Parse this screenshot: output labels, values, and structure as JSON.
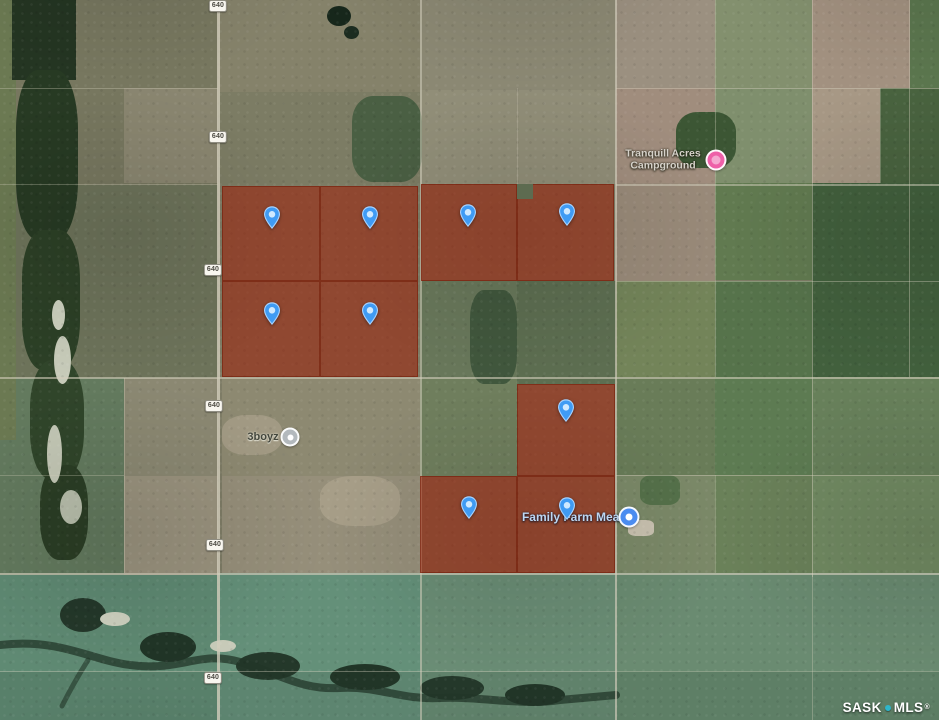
{
  "map": {
    "attribution": {
      "left": "SASK",
      "right": "MLS",
      "registered": "®",
      "dot_color": "#2eb6ca",
      "text_color": "#ffffff"
    },
    "highway_shield": {
      "label": "640",
      "positions": [
        {
          "x": 218,
          "y": 6
        },
        {
          "x": 218,
          "y": 137
        },
        {
          "x": 213,
          "y": 270
        },
        {
          "x": 214,
          "y": 406
        },
        {
          "x": 215,
          "y": 545
        },
        {
          "x": 213,
          "y": 678
        }
      ]
    },
    "poi_labels": [
      {
        "id": "tranquill-acres-campground",
        "lines": [
          "Tranquill Acres",
          "Campground"
        ],
        "style": "campground",
        "tx": 663,
        "ty": 160,
        "icon": {
          "name": "campground-poi-icon",
          "x": 716,
          "y": 160,
          "size": 17,
          "bg": "#ee60a8",
          "inner": "#f4a8d0",
          "inner_size": 9
        }
      },
      {
        "id": "threeboyz",
        "lines": [
          "3boyz"
        ],
        "style": "plain-dark",
        "tx": 263,
        "ty": 437,
        "icon": {
          "name": "generic-poi-icon",
          "x": 290,
          "y": 437,
          "size": 15,
          "bg": "#b3b9bd",
          "inner": "#ffffff",
          "inner_size": 6
        }
      },
      {
        "id": "family-farm-meats",
        "lines": [
          "Family Farm Meats"
        ],
        "style": "store",
        "tx": 576,
        "ty": 517,
        "icon": {
          "name": "store-poi-icon",
          "x": 629,
          "y": 517,
          "size": 17,
          "bg": "#4b8cf0",
          "inner": "#ffffff",
          "inner_size": 7
        }
      }
    ],
    "listing_pins": {
      "color_body": "#3f9bf4",
      "color_stroke": "#a6d2ff",
      "color_dot": "#cfe9ff",
      "points": [
        {
          "x": 272,
          "y": 234
        },
        {
          "x": 370,
          "y": 234
        },
        {
          "x": 468,
          "y": 232
        },
        {
          "x": 567,
          "y": 231
        },
        {
          "x": 272,
          "y": 330
        },
        {
          "x": 370,
          "y": 330
        },
        {
          "x": 566,
          "y": 427
        },
        {
          "x": 469,
          "y": 524
        },
        {
          "x": 567,
          "y": 525
        }
      ]
    },
    "parcel_overlays": {
      "fill": "rgba(158,30,5,0.55)",
      "border": "rgba(110,22,2,0.5)",
      "rects": [
        {
          "x": 222,
          "y": 186,
          "w": 98,
          "h": 95
        },
        {
          "x": 320,
          "y": 186,
          "w": 98,
          "h": 95
        },
        {
          "x": 222,
          "y": 281,
          "w": 98,
          "h": 96
        },
        {
          "x": 320,
          "y": 281,
          "w": 98,
          "h": 96
        },
        {
          "x": 421,
          "y": 184,
          "w": 96,
          "h": 97
        },
        {
          "x": 517,
          "y": 184,
          "w": 97,
          "h": 97
        },
        {
          "x": 517,
          "y": 384,
          "w": 98,
          "h": 92
        },
        {
          "x": 420,
          "y": 476,
          "w": 97,
          "h": 97
        },
        {
          "x": 517,
          "y": 476,
          "w": 98,
          "h": 97
        }
      ],
      "holes": [
        {
          "x": 517,
          "y": 184,
          "w": 16,
          "h": 15,
          "c": "#5d6b50"
        }
      ]
    },
    "roads": {
      "color": "#d2cdbb",
      "vertical": [
        {
          "x": 217,
          "y1": 0,
          "y2": 720,
          "w": 2.5,
          "o": 0.8
        },
        {
          "x": 420,
          "y1": 0,
          "y2": 720,
          "w": 1.5,
          "o": 0.55
        },
        {
          "x": 615,
          "y1": 0,
          "y2": 720,
          "w": 2,
          "o": 0.65
        },
        {
          "x": 812,
          "y1": 0,
          "y2": 577,
          "w": 1.2,
          "o": 0.45
        },
        {
          "x": 812,
          "y1": 573,
          "y2": 720,
          "w": 1.2,
          "o": 0.35
        },
        {
          "x": 909,
          "y1": 0,
          "y2": 377,
          "w": 1.2,
          "o": 0.4
        },
        {
          "x": 715,
          "y1": 0,
          "y2": 377,
          "w": 1,
          "o": 0.35
        },
        {
          "x": 715,
          "y1": 475,
          "y2": 573,
          "w": 1,
          "o": 0.3
        },
        {
          "x": 124,
          "y1": 378,
          "y2": 573,
          "w": 1,
          "o": 0.35
        },
        {
          "x": 880,
          "y1": 88,
          "y2": 183,
          "w": 1,
          "o": 0.3
        },
        {
          "x": 517,
          "y1": 88,
          "y2": 184,
          "w": 1,
          "o": 0.25
        }
      ],
      "horizontal": [
        {
          "y": 88,
          "x1": 0,
          "x2": 218,
          "h": 1,
          "o": 0.35
        },
        {
          "y": 88,
          "x1": 616,
          "x2": 939,
          "h": 1.2,
          "o": 0.45
        },
        {
          "y": 184,
          "x1": 616,
          "x2": 939,
          "h": 1.5,
          "o": 0.5
        },
        {
          "y": 184,
          "x1": 0,
          "x2": 218,
          "h": 1,
          "o": 0.3
        },
        {
          "y": 281,
          "x1": 616,
          "x2": 939,
          "h": 1,
          "o": 0.4
        },
        {
          "y": 377,
          "x1": 0,
          "x2": 939,
          "h": 1.8,
          "o": 0.6
        },
        {
          "y": 475,
          "x1": 616,
          "x2": 939,
          "h": 1.2,
          "o": 0.45
        },
        {
          "y": 475,
          "x1": 0,
          "x2": 124,
          "h": 1,
          "o": 0.3
        },
        {
          "y": 573,
          "x1": 0,
          "x2": 939,
          "h": 2,
          "o": 0.65
        },
        {
          "y": 671,
          "x1": 0,
          "x2": 616,
          "h": 1.2,
          "o": 0.4
        },
        {
          "y": 671,
          "x1": 616,
          "x2": 939,
          "h": 1,
          "o": 0.3
        }
      ]
    },
    "terrain": {
      "patches": [
        {
          "x": 0,
          "y": 0,
          "w": 218,
          "h": 185,
          "c": "#77775f"
        },
        {
          "x": 0,
          "y": 185,
          "w": 218,
          "h": 193,
          "c": "#6d735a"
        },
        {
          "x": 0,
          "y": 378,
          "w": 124,
          "h": 197,
          "c": "#637a5e"
        },
        {
          "x": 124,
          "y": 378,
          "w": 94,
          "h": 98,
          "c": "#8b8872"
        },
        {
          "x": 124,
          "y": 476,
          "w": 94,
          "h": 97,
          "c": "#9a937e"
        },
        {
          "x": 0,
          "y": 575,
          "w": 218,
          "h": 97,
          "c": "#5f8a73"
        },
        {
          "x": 0,
          "y": 672,
          "w": 218,
          "h": 48,
          "c": "#58806a"
        },
        {
          "x": 218,
          "y": 573,
          "w": 202,
          "h": 99,
          "c": "#649079"
        },
        {
          "x": 218,
          "y": 672,
          "w": 202,
          "h": 48,
          "c": "#5d8570"
        },
        {
          "x": 218,
          "y": 0,
          "w": 202,
          "h": 92,
          "c": "#85826a"
        },
        {
          "x": 218,
          "y": 92,
          "w": 202,
          "h": 93,
          "c": "#7c7c64"
        },
        {
          "x": 124,
          "y": 88,
          "w": 94,
          "h": 95,
          "c": "#8a8670"
        },
        {
          "x": 222,
          "y": 378,
          "w": 198,
          "h": 98,
          "c": "#8d8971"
        },
        {
          "x": 222,
          "y": 476,
          "w": 198,
          "h": 97,
          "c": "#968f7a"
        },
        {
          "x": 420,
          "y": 0,
          "w": 196,
          "h": 90,
          "c": "#8b8873"
        },
        {
          "x": 420,
          "y": 90,
          "w": 196,
          "h": 94,
          "c": "#918e78"
        },
        {
          "x": 420,
          "y": 281,
          "w": 97,
          "h": 97,
          "c": "#68775a"
        },
        {
          "x": 517,
          "y": 281,
          "w": 99,
          "h": 103,
          "c": "#5d6e51"
        },
        {
          "x": 420,
          "y": 378,
          "w": 97,
          "h": 98,
          "c": "#6f7e5d"
        },
        {
          "x": 420,
          "y": 573,
          "w": 196,
          "h": 99,
          "c": "#6a8d75"
        },
        {
          "x": 420,
          "y": 672,
          "w": 196,
          "h": 48,
          "c": "#60826b"
        },
        {
          "x": 616,
          "y": 0,
          "w": 99,
          "h": 88,
          "c": "#9b9080"
        },
        {
          "x": 715,
          "y": 0,
          "w": 97,
          "h": 88,
          "c": "#83906e"
        },
        {
          "x": 812,
          "y": 0,
          "w": 98,
          "h": 88,
          "c": "#a29180"
        },
        {
          "x": 910,
          "y": 0,
          "w": 29,
          "h": 88,
          "c": "#5b764e"
        },
        {
          "x": 616,
          "y": 88,
          "w": 99,
          "h": 95,
          "c": "#a08d7d"
        },
        {
          "x": 715,
          "y": 88,
          "w": 97,
          "h": 95,
          "c": "#7f8f6d"
        },
        {
          "x": 812,
          "y": 88,
          "w": 68,
          "h": 95,
          "c": "#a79885"
        },
        {
          "x": 880,
          "y": 88,
          "w": 59,
          "h": 95,
          "c": "#49633f"
        },
        {
          "x": 616,
          "y": 183,
          "w": 99,
          "h": 98,
          "c": "#998a79"
        },
        {
          "x": 715,
          "y": 183,
          "w": 97,
          "h": 97,
          "c": "#617a50"
        },
        {
          "x": 812,
          "y": 183,
          "w": 127,
          "h": 194,
          "c": "#42603d"
        },
        {
          "x": 616,
          "y": 281,
          "w": 99,
          "h": 96,
          "c": "#738459"
        },
        {
          "x": 715,
          "y": 281,
          "w": 97,
          "h": 96,
          "c": "#56734b"
        },
        {
          "x": 616,
          "y": 377,
          "w": 99,
          "h": 98,
          "c": "#697c58"
        },
        {
          "x": 715,
          "y": 377,
          "w": 97,
          "h": 98,
          "c": "#5d7b52"
        },
        {
          "x": 812,
          "y": 377,
          "w": 127,
          "h": 98,
          "c": "#67805a"
        },
        {
          "x": 616,
          "y": 475,
          "w": 99,
          "h": 98,
          "c": "#7b8968"
        },
        {
          "x": 715,
          "y": 475,
          "w": 97,
          "h": 98,
          "c": "#6a8159"
        },
        {
          "x": 812,
          "y": 475,
          "w": 127,
          "h": 98,
          "c": "#718a62"
        },
        {
          "x": 616,
          "y": 573,
          "w": 323,
          "h": 99,
          "c": "#6a8b71"
        },
        {
          "x": 616,
          "y": 672,
          "w": 323,
          "h": 48,
          "c": "#5e7f66"
        },
        {
          "x": 0,
          "y": 0,
          "w": 16,
          "h": 440,
          "c": "#6b7952"
        },
        {
          "x": 12,
          "y": 0,
          "w": 64,
          "h": 80,
          "c": "#243522"
        },
        {
          "x": 16,
          "y": 70,
          "w": 62,
          "h": 170,
          "c": "#273a23",
          "r": "35%"
        },
        {
          "x": 22,
          "y": 230,
          "w": 58,
          "h": 140,
          "c": "#2c4026",
          "r": "35%"
        },
        {
          "x": 30,
          "y": 360,
          "w": 54,
          "h": 120,
          "c": "#30452a",
          "r": "40%"
        },
        {
          "x": 40,
          "y": 465,
          "w": 48,
          "h": 95,
          "c": "#2b3e25",
          "r": "40%"
        },
        {
          "x": 52,
          "y": 300,
          "w": 13,
          "h": 30,
          "c": "#ccd0be",
          "r": "50%"
        },
        {
          "x": 54,
          "y": 336,
          "w": 17,
          "h": 48,
          "c": "#c7cbb9",
          "r": "50%"
        },
        {
          "x": 47,
          "y": 425,
          "w": 15,
          "h": 58,
          "c": "#c3c7b5",
          "r": "50%"
        },
        {
          "x": 60,
          "y": 490,
          "w": 22,
          "h": 34,
          "c": "#b9bfac",
          "r": "50%"
        },
        {
          "x": 327,
          "y": 6,
          "w": 24,
          "h": 20,
          "c": "#17271b",
          "r": "50%"
        },
        {
          "x": 344,
          "y": 26,
          "w": 15,
          "h": 13,
          "c": "#1c2c20",
          "r": "50%"
        },
        {
          "x": 377,
          "y": 103,
          "w": 17,
          "h": 15,
          "c": "#1f2f22",
          "r": "50%"
        },
        {
          "x": 352,
          "y": 96,
          "w": 70,
          "h": 86,
          "c": "#4a5f43",
          "r": "30%"
        },
        {
          "x": 470,
          "y": 290,
          "w": 47,
          "h": 94,
          "c": "#41573d",
          "r": "30%"
        },
        {
          "x": 676,
          "y": 112,
          "w": 60,
          "h": 56,
          "c": "#3c5634",
          "r": "35%"
        },
        {
          "x": 640,
          "y": 475,
          "w": 40,
          "h": 30,
          "c": "#55714a",
          "r": "30%"
        },
        {
          "x": 628,
          "y": 520,
          "w": 26,
          "h": 16,
          "c": "#c9c2b0",
          "r": "30%"
        },
        {
          "x": 222,
          "y": 415,
          "w": 60,
          "h": 40,
          "c": "#a29a84",
          "r": "40%"
        },
        {
          "x": 320,
          "y": 476,
          "w": 80,
          "h": 50,
          "c": "#a79e88",
          "r": "40%"
        },
        {
          "x": 60,
          "y": 598,
          "w": 46,
          "h": 34,
          "c": "#24382a",
          "r": "50%"
        },
        {
          "x": 140,
          "y": 632,
          "w": 56,
          "h": 30,
          "c": "#213527",
          "r": "50%"
        },
        {
          "x": 236,
          "y": 652,
          "w": 64,
          "h": 28,
          "c": "#24382a",
          "r": "50%"
        },
        {
          "x": 330,
          "y": 664,
          "w": 70,
          "h": 26,
          "c": "#213527",
          "r": "55%"
        },
        {
          "x": 420,
          "y": 676,
          "w": 64,
          "h": 24,
          "c": "#24382a",
          "r": "50%"
        },
        {
          "x": 505,
          "y": 684,
          "w": 60,
          "h": 22,
          "c": "#213527",
          "r": "50%"
        },
        {
          "x": 100,
          "y": 612,
          "w": 30,
          "h": 14,
          "c": "#cfd2c0",
          "r": "50%"
        },
        {
          "x": 210,
          "y": 640,
          "w": 26,
          "h": 12,
          "c": "#c9ccba",
          "r": "50%"
        }
      ]
    }
  }
}
